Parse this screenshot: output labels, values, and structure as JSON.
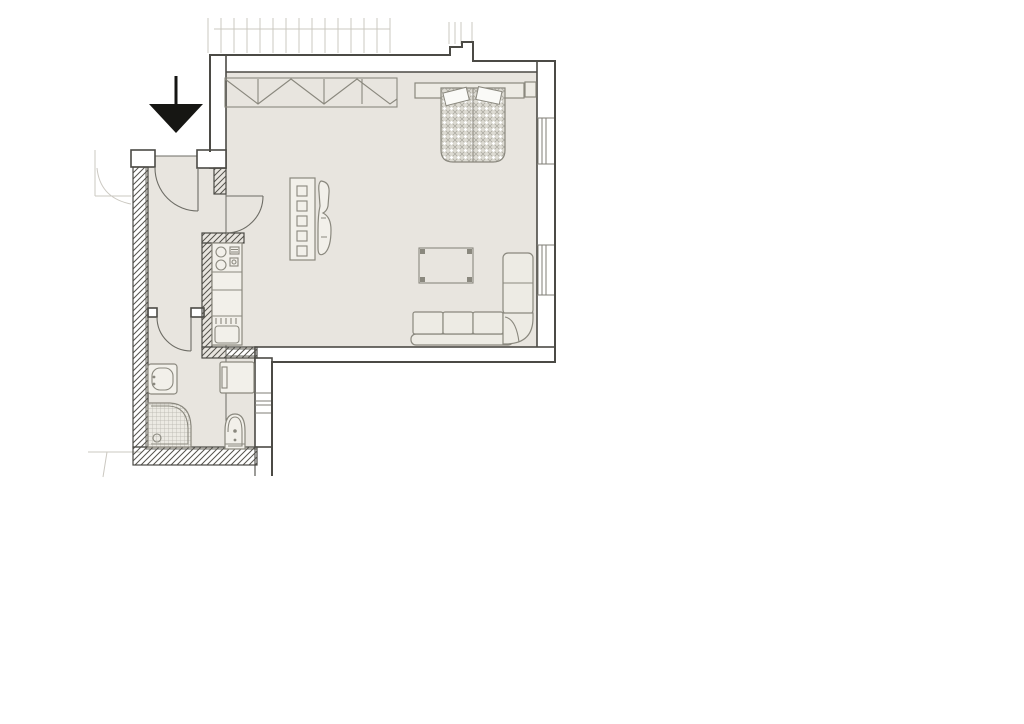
{
  "document": {
    "kind": "apartment floor plan drawing",
    "visible_text": "none",
    "entrance_marker": "solid black arrow pointing down at flat entry"
  },
  "palette": {
    "page_bg": "#ffffff",
    "floor": "#e8e5df",
    "wall_fill": "#ffffff",
    "outline": "#4b4a45",
    "interior_line": "#6d6c65",
    "furniture_line": "#8a887e",
    "furniture_fill": "#edebe4",
    "hatch_line": "#55534d",
    "bed_hatch": "#aeaca3",
    "faint": "#cbc8c1",
    "arrow": "#161613"
  },
  "rooms": [
    {
      "name": "living-room",
      "furniture": [
        "wardrobe-with-zigzag-symbol",
        "double-bed-with-pillows",
        "headboard",
        "nightstand",
        "shelf-unit-five-squares",
        "curved-chair",
        "coffee-table",
        "corner-sofa-with-chaise"
      ]
    },
    {
      "name": "hallway",
      "features": [
        "entry-door-swing",
        "interior-door-to-living-room"
      ]
    },
    {
      "name": "kitchen",
      "features": [
        "cooktop-two-burners",
        "counter-run",
        "kitchen-sink-with-drainer"
      ]
    },
    {
      "name": "bathroom",
      "features": [
        "washbasin",
        "quarter-round-shower",
        "toilet",
        "washing-machine",
        "door-swing"
      ]
    }
  ],
  "architecture": {
    "windows_right_wall": 2,
    "window_lower_wall": 1,
    "doors": 3,
    "hatched_walls": "diagonal hatch pattern",
    "context_lines": [
      "balcony ticks above top wall",
      "ghost door swing outside entry",
      "neighbouring structure below right"
    ]
  }
}
